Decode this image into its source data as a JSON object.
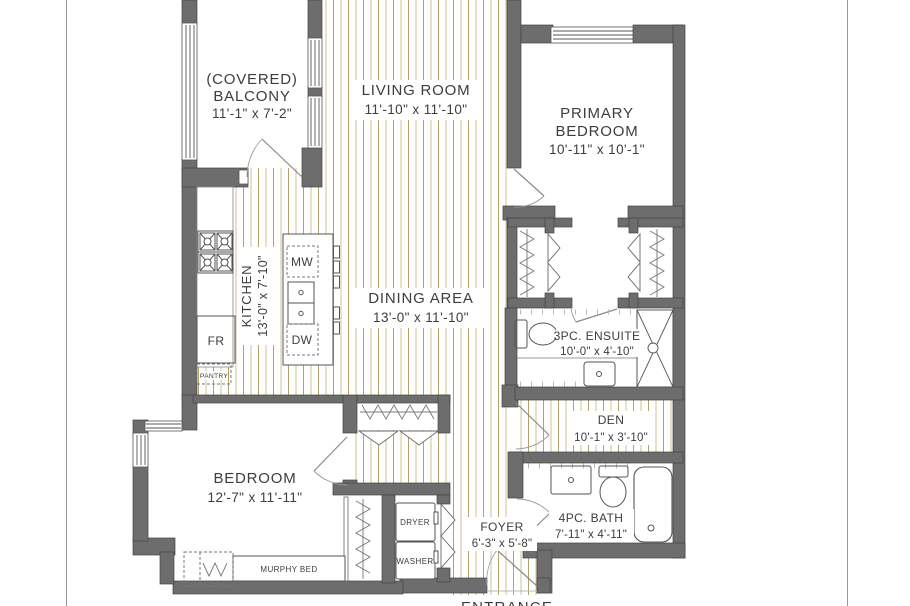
{
  "plan": {
    "rooms": {
      "balcony": {
        "name_line1": "(COVERED)",
        "name_line2": "BALCONY",
        "dims": "11'-1\" x 7'-2\""
      },
      "living_room": {
        "name": "LIVING ROOM",
        "dims": "11'-10\" x 11'-10\""
      },
      "primary_bedroom": {
        "name_line1": "PRIMARY",
        "name_line2": "BEDROOM",
        "dims": "10'-11\" x 10'-1\""
      },
      "kitchen": {
        "name": "KITCHEN",
        "dims": "13'-0\" x 7'-10\""
      },
      "dining_area": {
        "name": "DINING AREA",
        "dims": "13'-0\" x 11'-10\""
      },
      "ensuite": {
        "name": "3PC. ENSUITE",
        "dims": "10'-0\" x 4'-10\""
      },
      "den": {
        "name": "DEN",
        "dims": "10'-1\" x 3'-10\""
      },
      "bedroom": {
        "name": "BEDROOM",
        "dims": "12'-7\" x 11'-11\""
      },
      "foyer": {
        "name": "FOYER",
        "dims": "6'-3\" x 5'-8\""
      },
      "bath": {
        "name": "4PC. BATH",
        "dims": "7'-11\" x 4'-11\""
      }
    },
    "fixtures": {
      "microwave": "MW",
      "dishwasher": "DW",
      "fridge": "FR",
      "pantry": "PANTRY",
      "dryer": "DRYER",
      "washer": "WASHER",
      "murphy_bed": "MURPHY BED"
    },
    "entrance_label": "ENTRANCE",
    "colors": {
      "wall": "#6d6d6d",
      "floor_line_light": "#d3c292",
      "floor_line_dark": "#b3a06b",
      "label_text": "#3d3d3d"
    }
  }
}
